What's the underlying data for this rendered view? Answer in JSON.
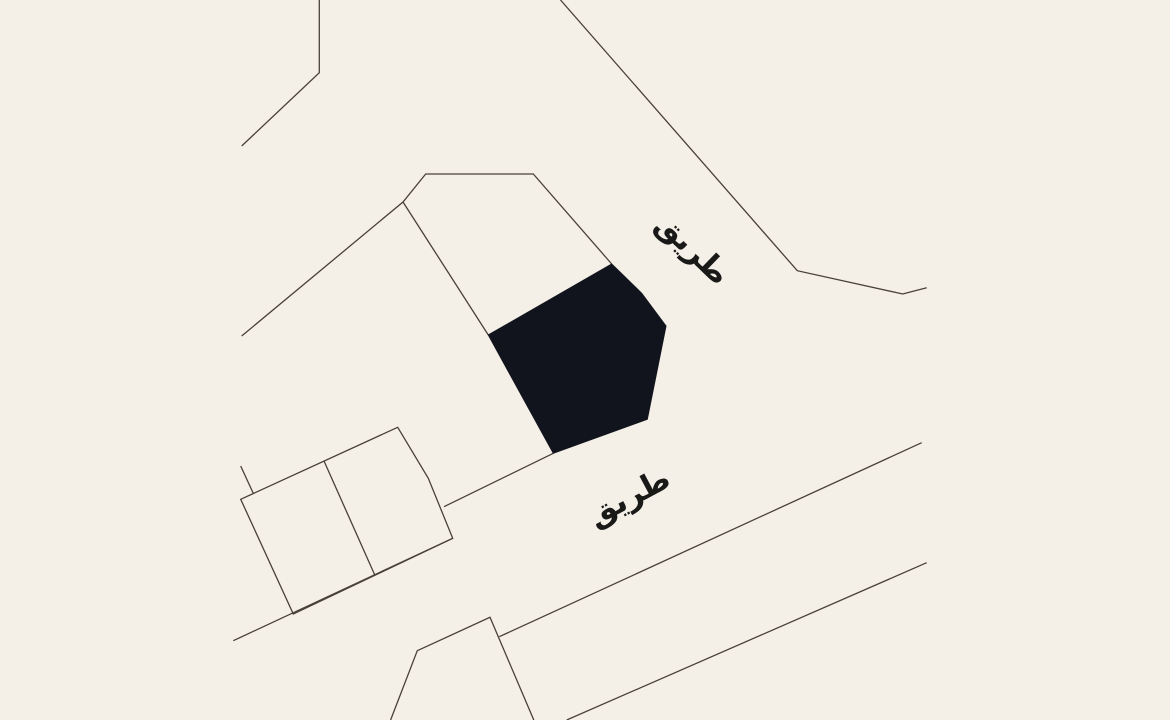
{
  "map": {
    "background_color": "#f4efe7",
    "stroke_color": "#474139",
    "stroke_width": 1.3,
    "parcel_fill_color": "#12141d",
    "label_color": "#191917",
    "labels": [
      {
        "id": "road-label-top",
        "text": "طريق",
        "x": 692.5,
        "y": 249,
        "rotation": 44,
        "font_size": 31
      },
      {
        "id": "road-label-bottom",
        "text": "طريق",
        "x": 629,
        "y": 497,
        "rotation": -28,
        "font_size": 31
      }
    ],
    "features": [
      {
        "name": "road-north-west",
        "type": "polyline",
        "points": [
          [
            319.3,
            0
          ],
          [
            319.3,
            72.7
          ],
          [
            241.7,
            146
          ]
        ]
      },
      {
        "name": "road-north-east",
        "type": "polyline",
        "points": [
          [
            560.5,
            0
          ],
          [
            797.3,
            270.7
          ],
          [
            902.7,
            294
          ],
          [
            926.7,
            287.7
          ]
        ]
      },
      {
        "name": "parcel-boundary-north",
        "type": "polyline",
        "points": [
          [
            241.7,
            336
          ],
          [
            403,
            202
          ],
          [
            425.7,
            174
          ],
          [
            533.3,
            174
          ],
          [
            611.7,
            264
          ]
        ]
      },
      {
        "name": "parcel-boundary-west",
        "type": "polyline",
        "points": [
          [
            403,
            202
          ],
          [
            488.3,
            335
          ]
        ]
      },
      {
        "name": "parcel-boundary-south",
        "type": "polyline",
        "points": [
          [
            553.3,
            453.3
          ],
          [
            444,
            506.7
          ]
        ]
      },
      {
        "name": "building-block-outline",
        "type": "polygon",
        "closed": true,
        "points": [
          [
            240.7,
            499.3
          ],
          [
            397.7,
            427.3
          ],
          [
            428.3,
            478.3
          ],
          [
            452.7,
            538.3
          ],
          [
            293.3,
            614
          ]
        ]
      },
      {
        "name": "building-block-divider",
        "type": "polyline",
        "points": [
          [
            324,
            461
          ],
          [
            375,
            575.5
          ]
        ]
      },
      {
        "name": "building-block-spur",
        "type": "polyline",
        "points": [
          [
            240.7,
            466
          ],
          [
            253.3,
            493.4
          ]
        ]
      },
      {
        "name": "road-south-west",
        "type": "polyline",
        "points": [
          [
            233.3,
            640.7
          ],
          [
            452.7,
            538.3
          ]
        ]
      },
      {
        "name": "road-mid-east",
        "type": "polyline",
        "points": [
          [
            499.3,
            636.7
          ],
          [
            921.7,
            442.7
          ]
        ]
      },
      {
        "name": "road-south-east",
        "type": "polyline",
        "points": [
          [
            566.7,
            720
          ],
          [
            926.7,
            562.7
          ]
        ]
      },
      {
        "name": "building-south",
        "type": "polyline",
        "points": [
          [
            533.8,
            720
          ],
          [
            490,
            617.3
          ],
          [
            417.3,
            650.7
          ],
          [
            398.3,
            700
          ],
          [
            390.6,
            720
          ]
        ]
      },
      {
        "name": "selected-parcel",
        "type": "polygon",
        "fill": true,
        "interactable": true,
        "points": [
          [
            611.7,
            264
          ],
          [
            641.7,
            293.3
          ],
          [
            666,
            326
          ],
          [
            647.3,
            419.3
          ],
          [
            553.3,
            453.3
          ],
          [
            488.3,
            335
          ]
        ]
      }
    ]
  }
}
